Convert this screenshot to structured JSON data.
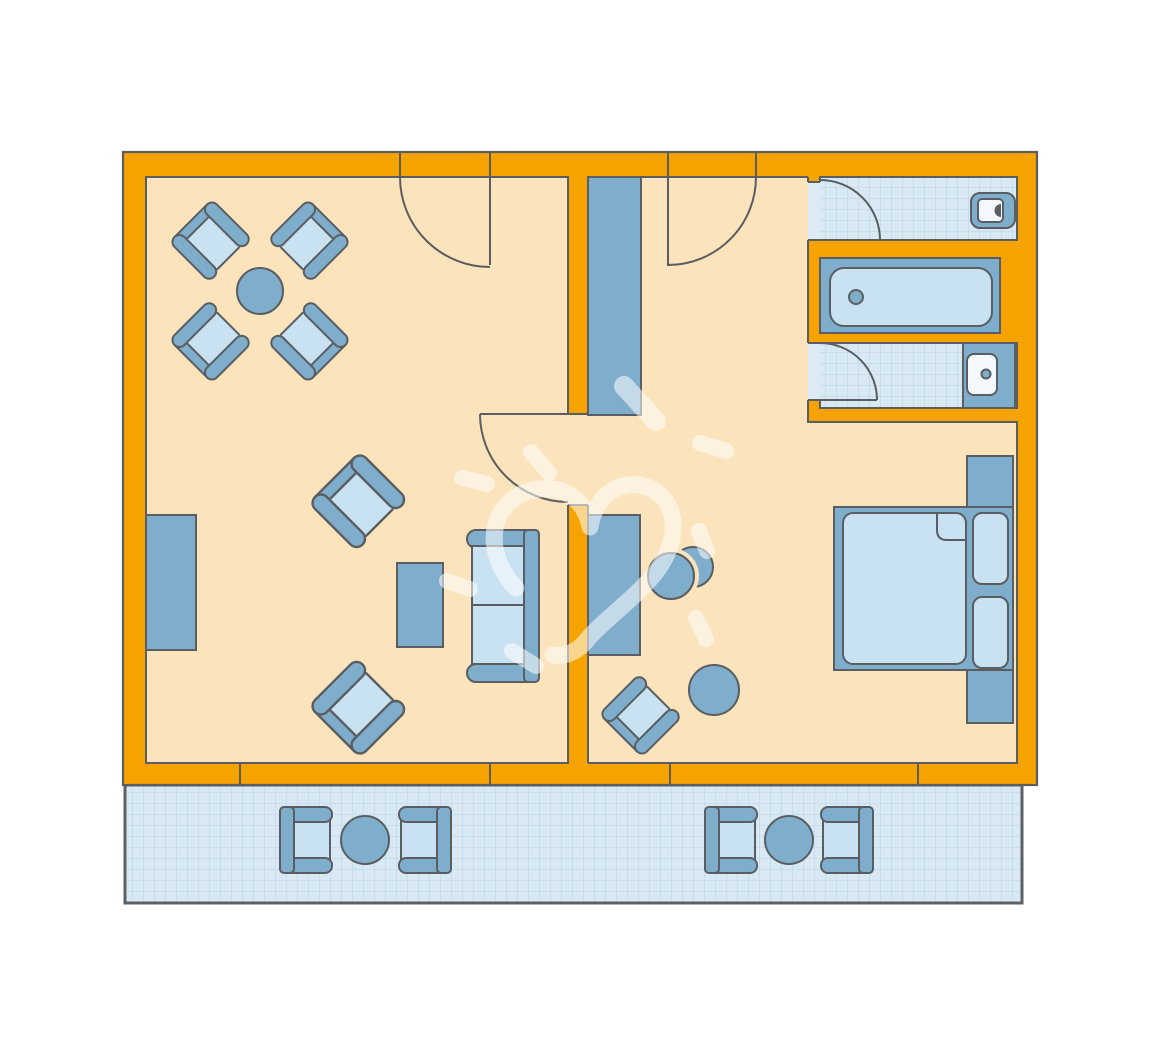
{
  "colors": {
    "background": "#FFFFFF",
    "wall": "#F6A201",
    "floor": "#FBE3BC",
    "mid": "#7FAECC",
    "light": "#C9E2F2",
    "fixture": "#F2F8FC",
    "tile": "#D8E9F3",
    "tile_grid": "#BAD4E6",
    "gap_strip": "#DCEAF5",
    "outline": "#5A5D61",
    "balcony_outline": "#5E6163",
    "watermark": "#FFFFFF"
  },
  "plan": {
    "type": "apartment-floor-plan",
    "rooms": [
      {
        "name": "living-room",
        "floor": "cream",
        "furniture": [
          "round-dining-table",
          "dining-chair x4",
          "armchair x2",
          "sofa",
          "coffee-table",
          "sideboard"
        ]
      },
      {
        "name": "hall",
        "floor": "cream",
        "furniture": [
          "wardrobe"
        ]
      },
      {
        "name": "bedroom",
        "floor": "cream",
        "furniture": [
          "double-bed",
          "nightstand x2",
          "desk",
          "desk-chair",
          "armchair",
          "round-side-table"
        ]
      },
      {
        "name": "wc",
        "floor": "tiles",
        "furniture": [
          "toilet"
        ]
      },
      {
        "name": "bath",
        "floor": "blue",
        "furniture": [
          "bathtub"
        ]
      },
      {
        "name": "shower-room",
        "floor": "tiles",
        "furniture": [
          "washbasin",
          "vanity-counter"
        ]
      },
      {
        "name": "balcony",
        "floor": "tiles",
        "furniture": [
          "bistro-set x2 (2 chairs + round table each)"
        ]
      }
    ],
    "door_count": 5,
    "window_section_count": 2,
    "watermark": "white hand-drawn heart with dashes"
  }
}
